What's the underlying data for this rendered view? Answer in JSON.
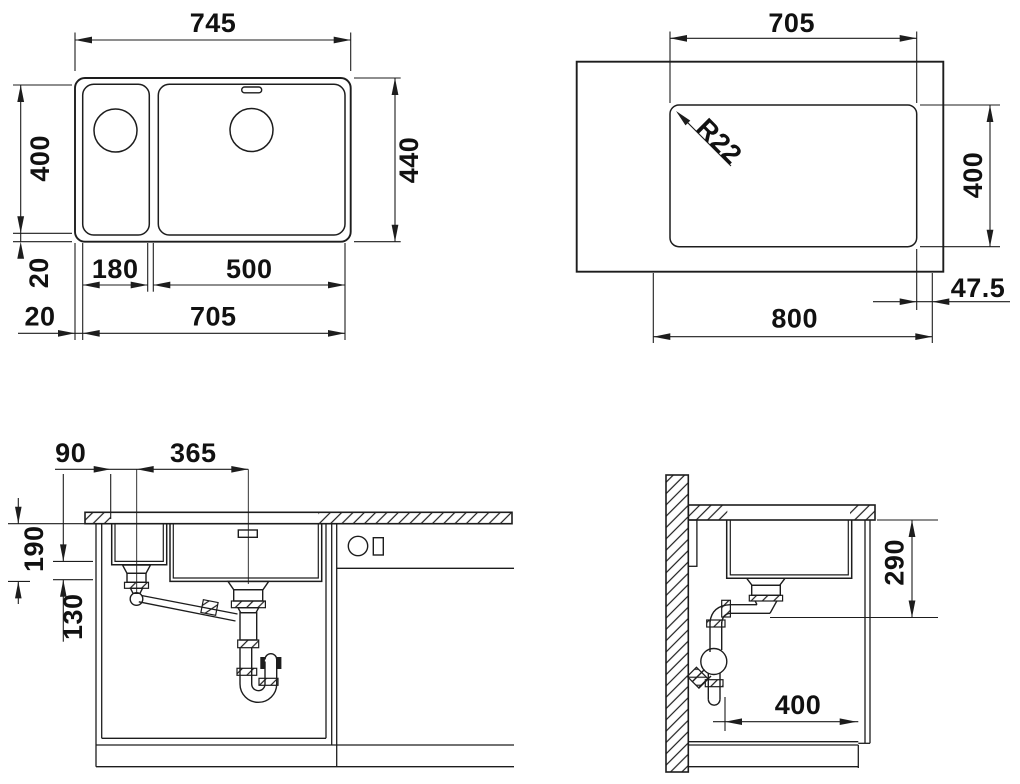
{
  "drawing": {
    "background": "#ffffff",
    "line_color": "#1d1d1d",
    "views": {
      "plan": {
        "dims": {
          "overall_width": "745",
          "inner_depth": "400",
          "overall_depth": "440",
          "rim_depth": "20",
          "rim_side": "20",
          "small_bowl_width": "180",
          "main_bowl_width": "500",
          "cutout_width": "705"
        }
      },
      "cutout": {
        "dims": {
          "cutout_width": "705",
          "corner_radius": "R22",
          "cutout_depth": "400",
          "min_cabinet_width": "800",
          "edge_distance": "47.5"
        }
      },
      "front_section": {
        "dims": {
          "drain_offset": "90",
          "drain_spacing": "365",
          "main_bowl_depth": "190",
          "small_bowl_depth": "130"
        }
      },
      "side_section": {
        "dims": {
          "clearance_depth": "290",
          "trap_clearance": "400"
        }
      }
    }
  }
}
